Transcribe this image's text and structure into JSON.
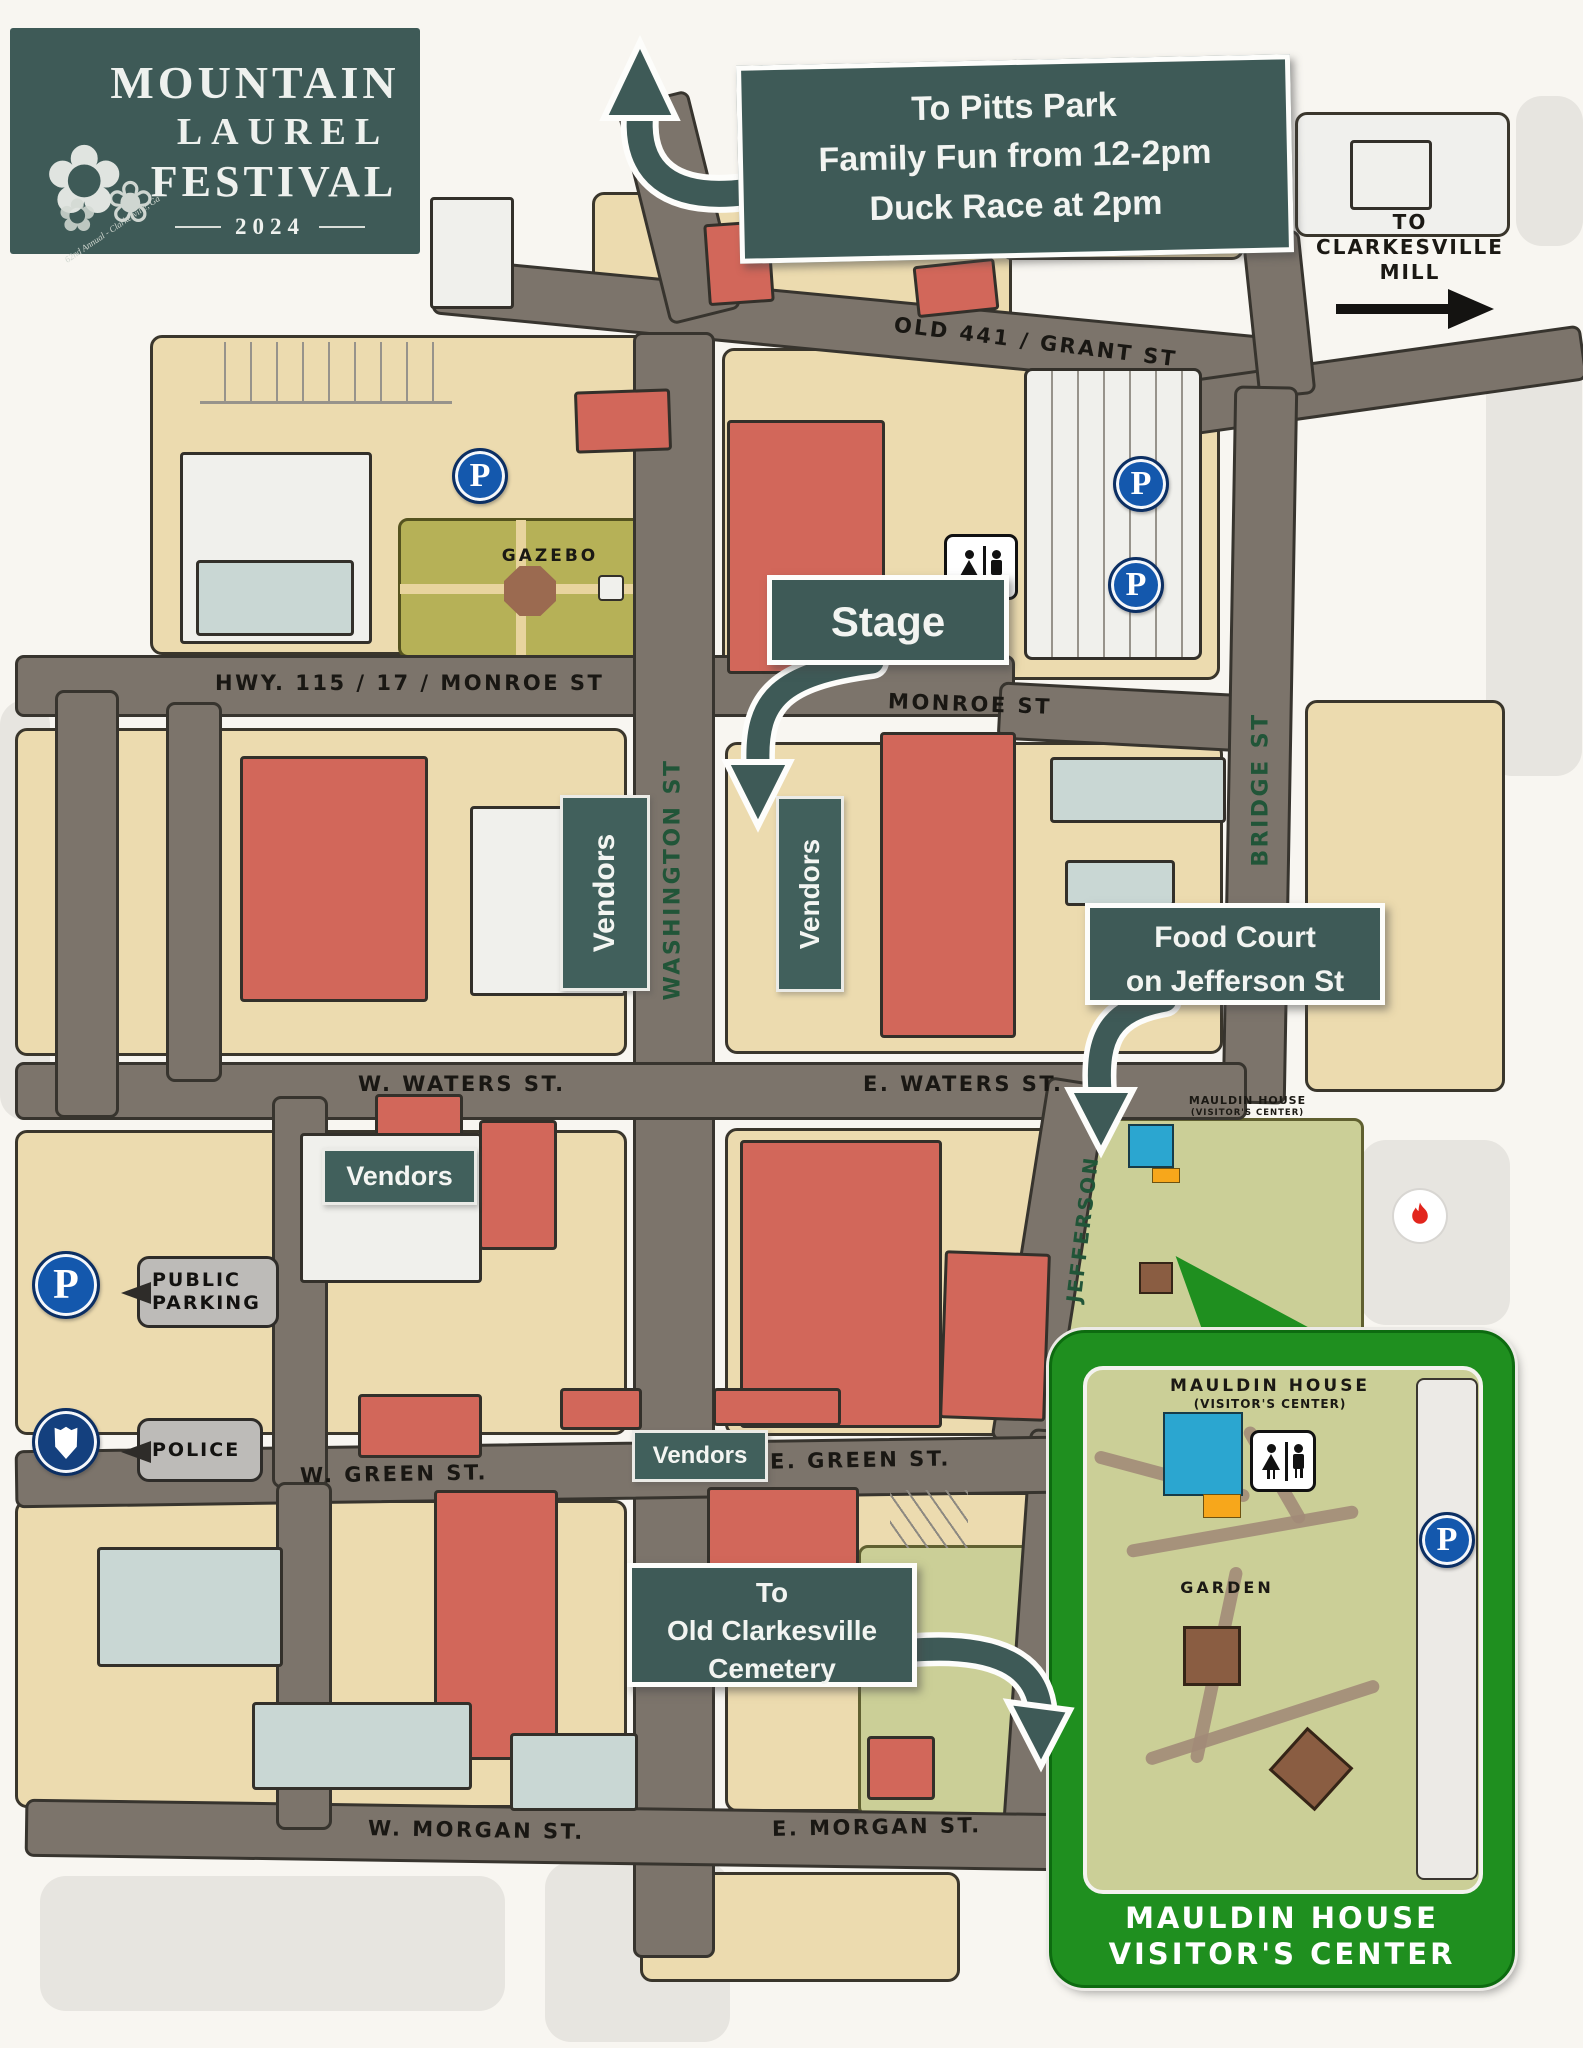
{
  "logo": {
    "line1": "MOUNTAIN",
    "line2": "LAUREL",
    "line3": "FESTIVAL",
    "year": "2024",
    "tagline": "62nd Annual - Clarkesville, Ga"
  },
  "callouts": {
    "pitts_park": {
      "line1": "To Pitts Park",
      "line2": "Family Fun from 12-2pm",
      "line3": "Duck Race at 2pm"
    },
    "stage": {
      "label": "Stage"
    },
    "food_court": {
      "line1": "Food Court",
      "line2": "on Jefferson St"
    },
    "cemetery": {
      "line1": "To",
      "line2": "Old Clarkesville",
      "line3": "Cemetery"
    },
    "mill": {
      "line1": "TO",
      "line2": "CLARKESVILLE",
      "line3": "MILL"
    }
  },
  "streets": {
    "grant": "OLD 441 / GRANT ST",
    "hwy_monroe": "HWY. 115 / 17 / MONROE ST",
    "monroe": "MONROE ST",
    "washington": "WASHINGTON ST",
    "bridge": "BRIDGE ST",
    "jefferson": "JEFFERSON",
    "w_waters": "W. WATERS ST.",
    "e_waters": "E. WATERS ST.",
    "w_green": "W. GREEN ST.",
    "e_green": "E. GREEN ST.",
    "w_morgan": "W. MORGAN ST.",
    "e_morgan": "E. MORGAN ST."
  },
  "labels": {
    "gazebo": "GAZEBO",
    "garden": "GARDEN",
    "vendors": "Vendors",
    "mauldin_map_line1": "MAULDIN HOUSE",
    "mauldin_map_line2": "(VISITOR'S CENTER)",
    "inset_label_line1": "MAULDIN HOUSE",
    "inset_label_line2": "(VISITOR'S CENTER)",
    "inset_caption_line1": "MAULDIN HOUSE",
    "inset_caption_line2": "VISITOR'S CENTER"
  },
  "legend": {
    "parking_line1": "PUBLIC",
    "parking_line2": "PARKING",
    "police": "POLICE",
    "parking_letter": "P"
  },
  "colors": {
    "callout_teal": "#3e5a57",
    "inset_green": "#1f8f1f",
    "parking_blue": "#1458ad",
    "road": "#7c746b",
    "building_red": "#d2675a",
    "lawn_olive": "#b6b157"
  }
}
